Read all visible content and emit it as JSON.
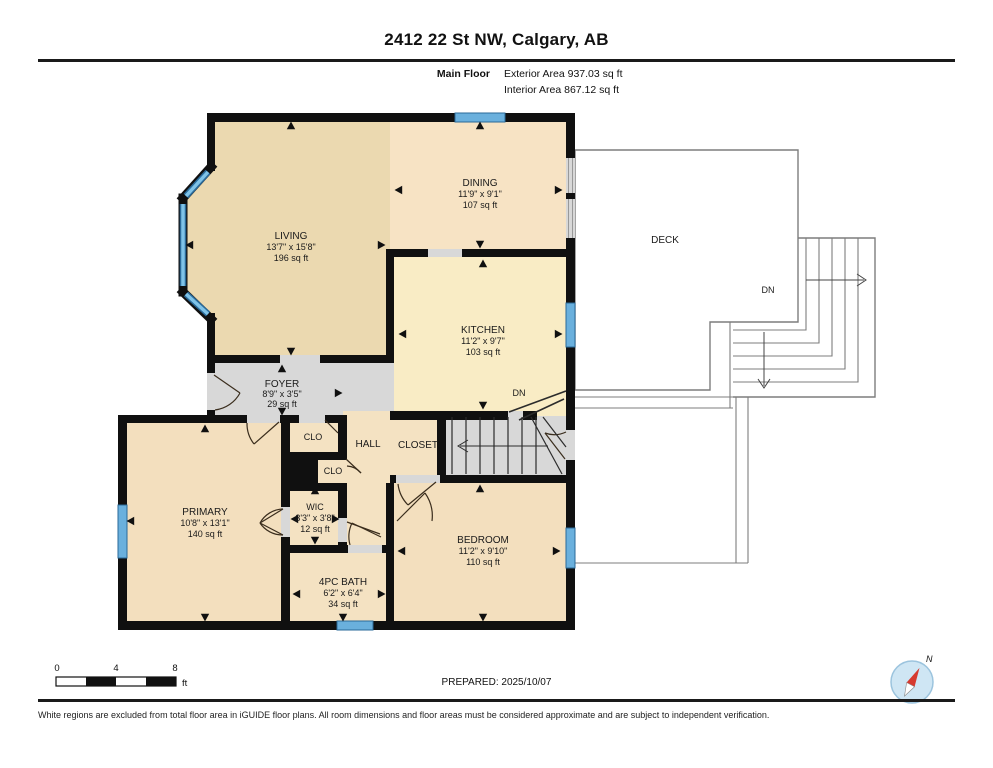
{
  "header": {
    "title": "2412 22 St NW, Calgary, AB",
    "floor_label": "Main Floor",
    "exterior_area": "Exterior Area 937.03 sq ft",
    "interior_area": "Interior Area 867.12 sq ft"
  },
  "rooms": {
    "living": {
      "name": "LIVING",
      "dims": "13'7\" x 15'8\"",
      "area": "196 sq ft"
    },
    "dining": {
      "name": "DINING",
      "dims": "11'9\" x 9'1\"",
      "area": "107 sq ft"
    },
    "kitchen": {
      "name": "KITCHEN",
      "dims": "11'2\" x 9'7\"",
      "area": "103 sq ft"
    },
    "foyer": {
      "name": "FOYER",
      "dims": "8'9\" x 3'5\"",
      "area": "29 sq ft"
    },
    "primary": {
      "name": "PRIMARY",
      "dims": "10'8\" x 13'1\"",
      "area": "140 sq ft"
    },
    "wic": {
      "name": "WIC",
      "dims": "3'3\" x 3'8\"",
      "area": "12 sq ft"
    },
    "bath": {
      "name": "4PC BATH",
      "dims": "6'2\" x 6'4\"",
      "area": "34 sq ft"
    },
    "bedroom": {
      "name": "BEDROOM",
      "dims": "11'2\" x 9'10\"",
      "area": "110 sq ft"
    },
    "hall": {
      "name": "HALL"
    },
    "closet": {
      "name": "CLOSET"
    },
    "clo1": {
      "name": "CLO"
    },
    "clo2": {
      "name": "CLO"
    },
    "deck": {
      "name": "DECK"
    }
  },
  "labels": {
    "dn_interior": "DN",
    "dn_deck": "DN",
    "north": "N"
  },
  "scale_bar": {
    "t0": "0",
    "t4": "4",
    "t8": "8",
    "unit": "ft"
  },
  "footer": {
    "prepared": "PREPARED: 2025/10/07",
    "disclaimer": "White regions are excluded from total floor area in iGUIDE floor plans. All room dimensions and floor areas must be considered approximate and are subject to independent verification."
  },
  "colors": {
    "wall": "#101010",
    "window_blue": "#6ab0dd",
    "window_edge": "#2a6a99",
    "floor_living": "#ebd9b0",
    "floor_dining": "#f7e3c4",
    "floor_kitchen": "#f9ecc5",
    "floor_bedroom": "#f3dfbe",
    "floor_hall": "#f4e2c2",
    "floor_gray": "#d8d8d8",
    "deck_line": "#7d7d7d",
    "compass_red": "#d63a2f",
    "compass_fill": "#cfe6f4"
  }
}
